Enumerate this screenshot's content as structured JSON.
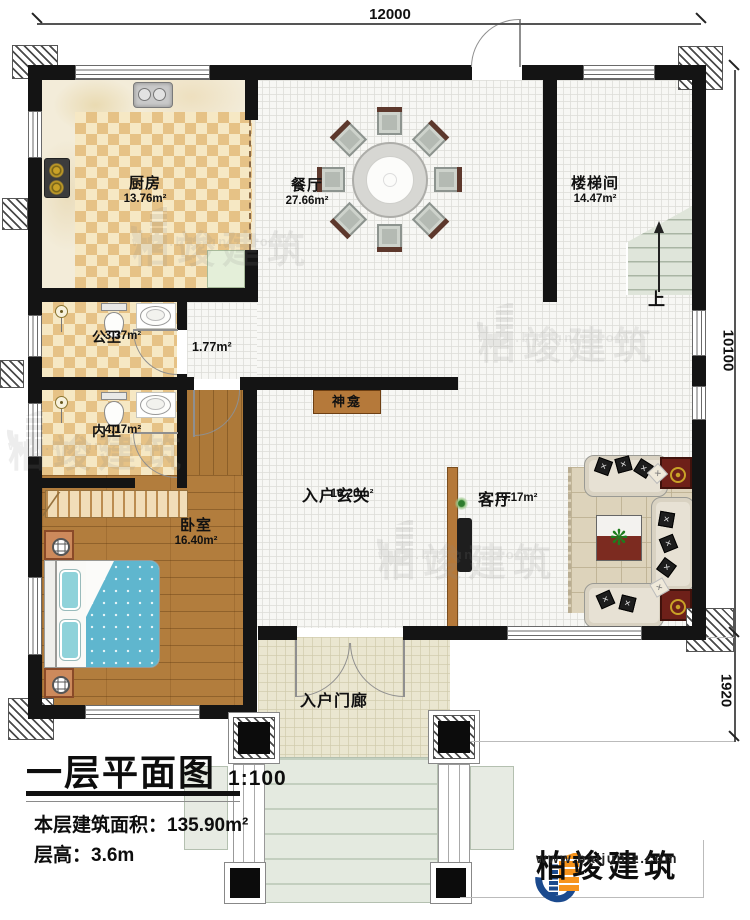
{
  "dimensions": {
    "top": "12000",
    "right_upper": "10100",
    "right_lower": "1920"
  },
  "rooms": [
    {
      "name": "厨房",
      "area": "13.76m²"
    },
    {
      "name": "餐厅",
      "area": "27.66m²"
    },
    {
      "name": "楼梯间",
      "area": "14.47m²"
    },
    {
      "name": "公卫",
      "area": "3.37m²"
    },
    {
      "name": "",
      "area": "1.77m²"
    },
    {
      "name": "内卫",
      "area": "4.17m²"
    },
    {
      "name": "卧室",
      "area": "16.40m²"
    },
    {
      "name": "入户玄关",
      "area": "16.20m²"
    },
    {
      "name": "客厅",
      "area": "19.17m²"
    },
    {
      "name": "入户门廊",
      "area": ""
    }
  ],
  "annotations": {
    "shrine": "神龛",
    "stair_up": "上"
  },
  "title_block": {
    "title": "一层平面图",
    "scale": "1:100",
    "floor_area_label": "本层建筑面积：",
    "floor_area_value": "135.90m²",
    "floor_height_label": "层高：",
    "floor_height_value": "3.6m"
  },
  "branding": {
    "company": "柏竣建筑",
    "website": "www.baijunjz.com"
  },
  "watermark": {
    "text": "柏竣建筑",
    "url": "www.baijunjz.com"
  },
  "colors": {
    "wall": "#141414",
    "checker": "#e6c286",
    "wood": "#b27d3d",
    "accent_blue": "#1b4a8e",
    "accent_orange": "#f7941d"
  }
}
